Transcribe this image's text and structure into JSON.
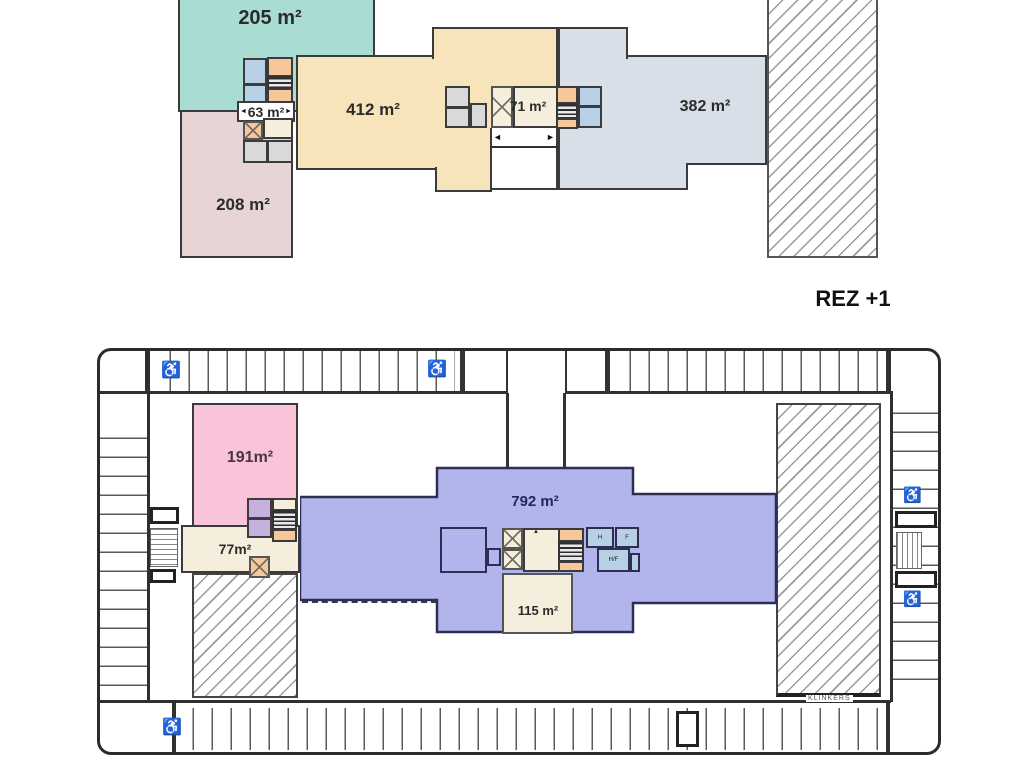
{
  "floor_title": "REZ +1",
  "upper_plan": {
    "zone_teal_label": "205 m²",
    "zone_rose_label": "208 m²",
    "zone_tan_label": "412 m²",
    "zone_blue_label": "382 m²",
    "core_left_label": "63 m²",
    "core_center_label": "71 m²",
    "arrow_left": "◄",
    "arrow_right": "►"
  },
  "lower_plan": {
    "zone_pink_label": "191m²",
    "zone_purple_label": "792 m²",
    "lobby_left_label": "77m²",
    "lobby_bottom_label": "115 m²",
    "paving_label": "KLINKERS",
    "room_h_label": "H",
    "room_f_label": "F",
    "room_hf_label": "H/F",
    "accessible_icon": "♿",
    "direction_marker": "▲"
  },
  "colors": {
    "teal_zone": "#a9ddd3",
    "rose_zone": "#e6d5d4",
    "tan_zone": "#f7e4ba",
    "blue_zone": "#d9dfe9",
    "pink_zone": "#f9c3da",
    "purple_zone": "#b2b5eb",
    "cream_room": "#f6eedd",
    "orange_room": "#f6c79b",
    "blue_room": "#b7d0e6",
    "gray_room": "#d9d9d9",
    "lavender_room": "#c6b0e0",
    "wall": "#333333",
    "hatch_line": "#9a9a9a"
  }
}
